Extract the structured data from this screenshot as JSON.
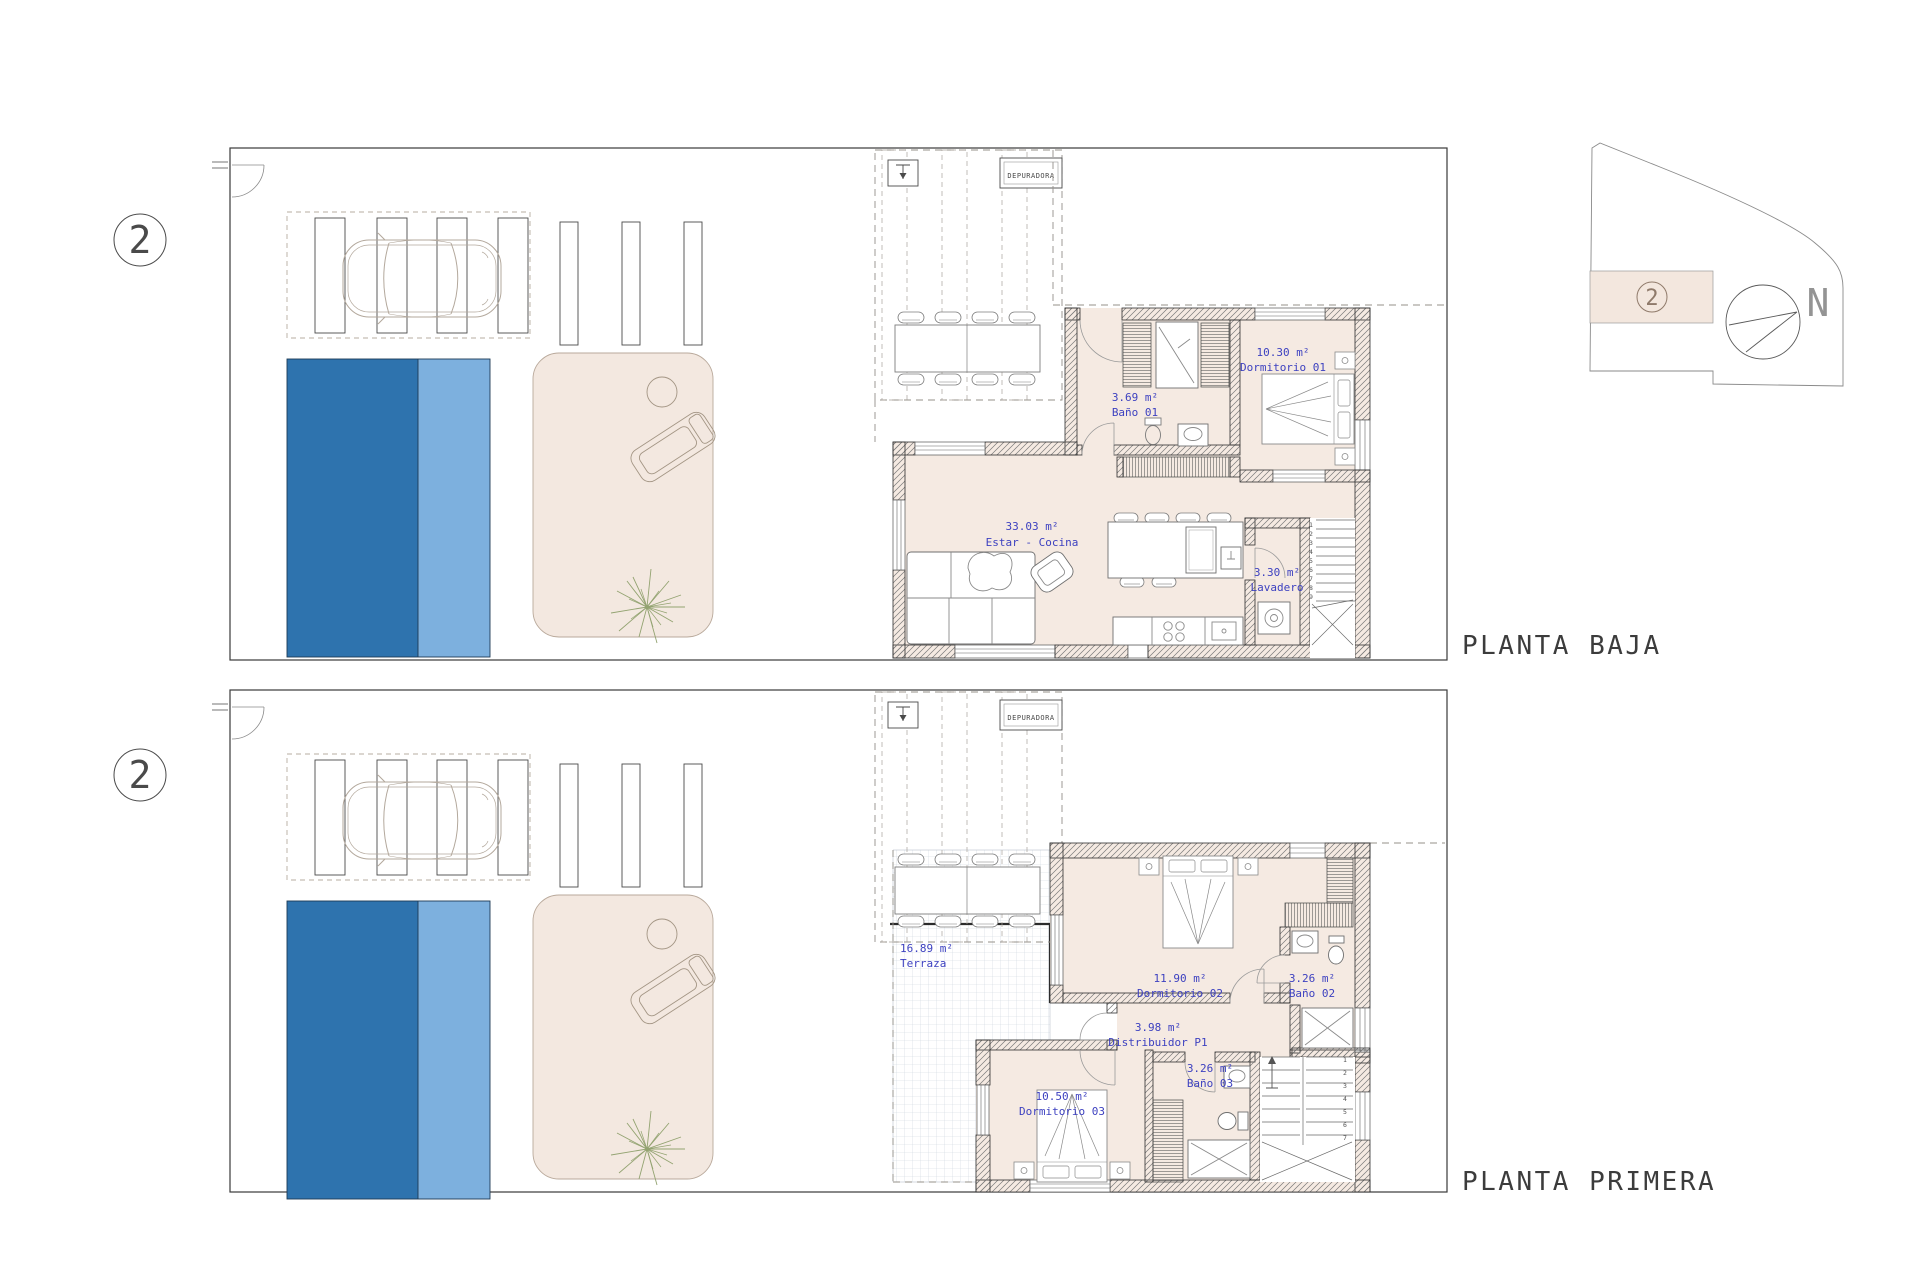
{
  "document": {
    "type": "architectural floor plans, unit 2 of a villa",
    "background": "#ffffff"
  },
  "colors": {
    "pool_dark": "#2e73ae",
    "pool_light": "#7db0de",
    "floor_beige": "#f5eae2",
    "patio_beige": "#f3e8e0",
    "label_blue": "#3d41c0",
    "wall_line": "#2f2f2f",
    "tile_grid": "#ccd5de"
  },
  "key_plan": {
    "unit_number": "2",
    "north_label": "N"
  },
  "planta_baja": {
    "title": "PLANTA BAJA",
    "unit_number": "2",
    "equipment_label": "DEPURADORA",
    "rooms": {
      "estar_cocina": {
        "area": "33.03 m²",
        "name": "Estar - Cocina"
      },
      "bano01": {
        "area": "3.69 m²",
        "name": "Baño 01"
      },
      "dormitorio01": {
        "area": "10.30 m²",
        "name": "Dormitorio 01"
      },
      "lavadero": {
        "area": "3.30 m²",
        "name": "Lavadero"
      }
    },
    "stairs": {
      "numbers": [
        "1",
        "2",
        "3",
        "4",
        "5",
        "6",
        "7",
        "8",
        "9"
      ]
    }
  },
  "planta_primera": {
    "title": "PLANTA PRIMERA",
    "unit_number": "2",
    "equipment_label": "DEPURADORA",
    "rooms": {
      "terraza": {
        "area": "16.89 m²",
        "name": "Terraza"
      },
      "dormitorio02": {
        "area": "11.90 m²",
        "name": "Dormitorio 02"
      },
      "bano02": {
        "area": "3.26 m²",
        "name": "Baño 02"
      },
      "distribuidor": {
        "area": "3.98 m²",
        "name": "Distribuidor P1"
      },
      "bano03": {
        "area": "3.26 m²",
        "name": "Baño 03"
      },
      "dormitorio03": {
        "area": "10.50 m²",
        "name": "Dormitorio 03"
      }
    },
    "stairs": {
      "numbers": [
        "1",
        "2",
        "3",
        "4",
        "5",
        "6",
        "7"
      ]
    }
  }
}
